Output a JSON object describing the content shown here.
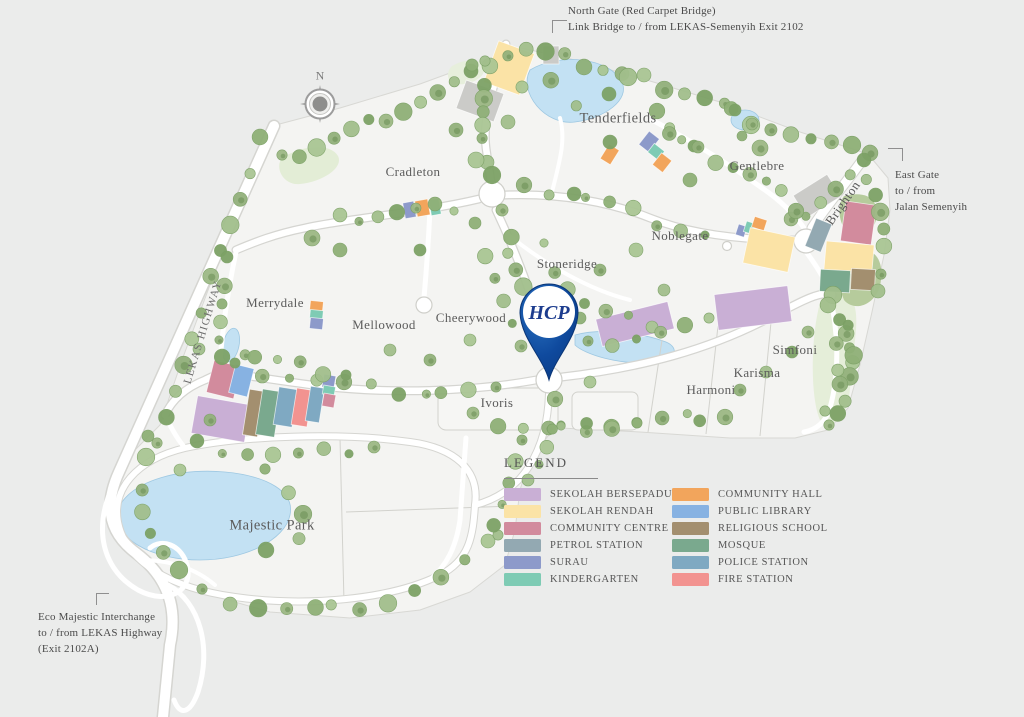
{
  "legend": {
    "title": "LEGEND",
    "items": [
      {
        "label": "SEKOLAH BERSEPADU",
        "color": "#c9afd5"
      },
      {
        "label": "SEKOLAH RENDAH",
        "color": "#fbe3a6"
      },
      {
        "label": "COMMUNITY CENTRE",
        "color": "#d28b9d"
      },
      {
        "label": "PETROL STATION",
        "color": "#93a9b2"
      },
      {
        "label": "SURAU",
        "color": "#8d9aca"
      },
      {
        "label": "KINDERGARTEN",
        "color": "#7ecbb4"
      },
      {
        "label": "COMMUNITY HALL",
        "color": "#f2a55c"
      },
      {
        "label": "PUBLIC LIBRARY",
        "color": "#87b2e2"
      },
      {
        "label": "RELIGIOUS SCHOOL",
        "color": "#a38f6f"
      },
      {
        "label": "MOSQUE",
        "color": "#7aa98e"
      },
      {
        "label": "POLICE STATION",
        "color": "#7fa9c2"
      },
      {
        "label": "FIRE STATION",
        "color": "#f29390"
      }
    ]
  },
  "annotations": {
    "north_gate": {
      "line1": "North Gate (Red Carpet Bridge)",
      "line2": "Link Bridge to / from LEKAS-Semenyih Exit 2102"
    },
    "east_gate": {
      "line1": "East Gate",
      "line2": "to / from",
      "line3": "Jalan Semenyih"
    },
    "interchange": {
      "line1": "Eco Majestic Interchange",
      "line2": "to / from LEKAS Highway",
      "line3": "(Exit 2102A)"
    }
  },
  "areas": [
    "Tenderfields",
    "Cradleton",
    "Gentlebre",
    "Noblegate",
    "Stoneridge",
    "Merrydale",
    "Mellowood",
    "Cheerywood",
    "Ivoris",
    "Majestic Park",
    "Harmoni",
    "Karisma",
    "Simfoni"
  ],
  "roads": {
    "highway": "LEKAS HIGHWAY",
    "brighton": "Brighton"
  },
  "compass": {
    "label": "N"
  },
  "marker": {
    "label": "HCP",
    "color": "#0d4a9c"
  }
}
